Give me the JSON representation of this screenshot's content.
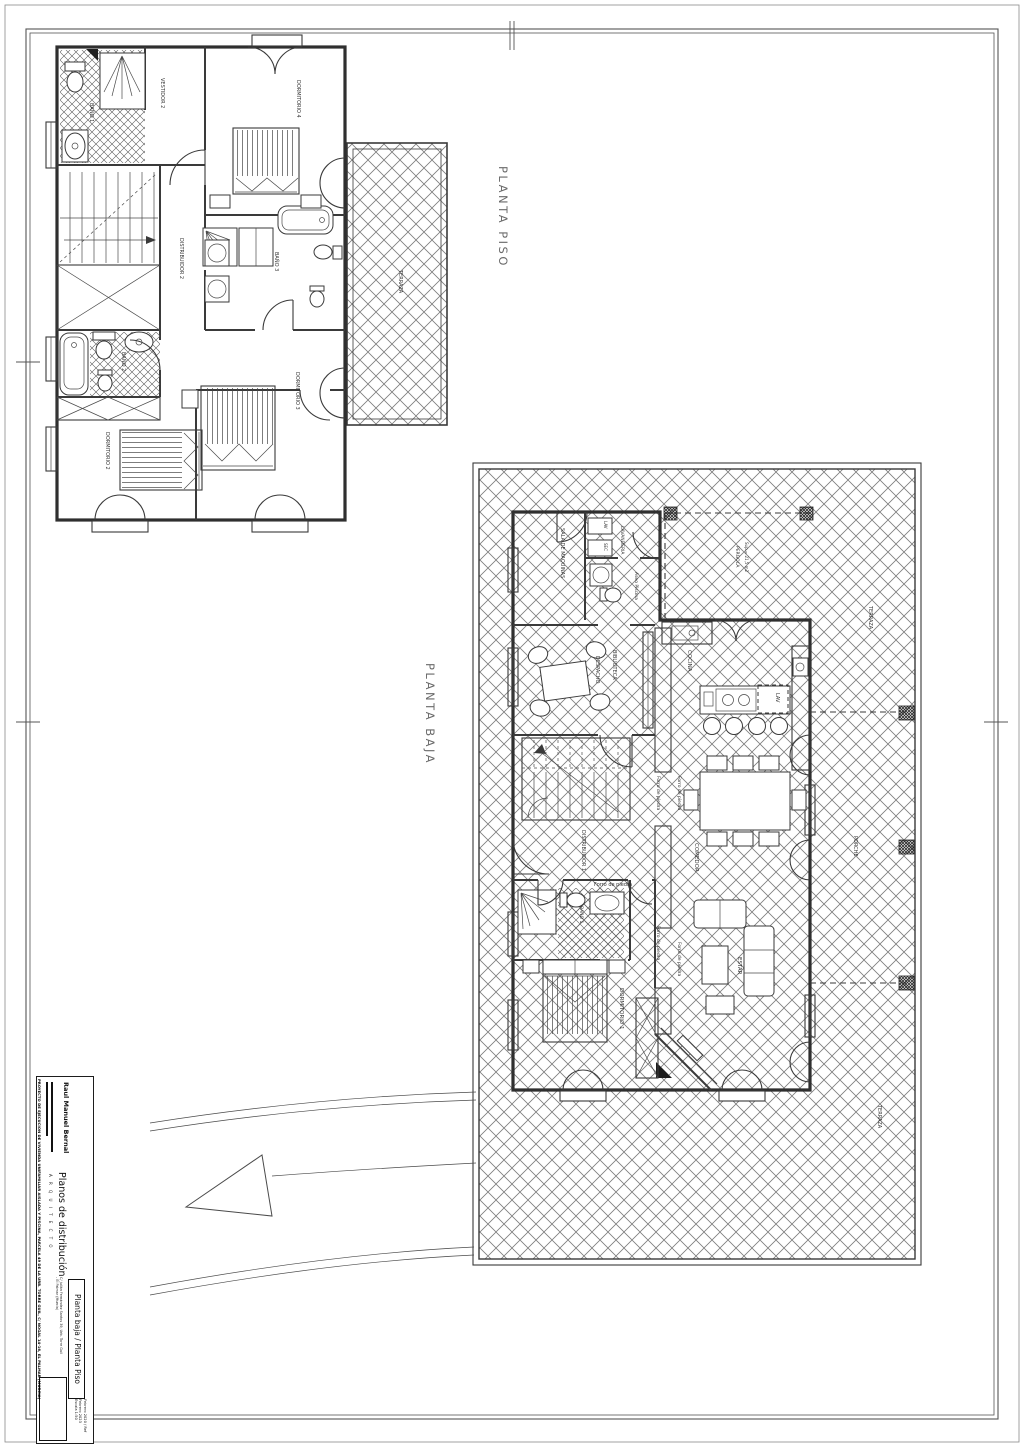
{
  "sheet_titles": {
    "planta_piso": "PLANTA PISO",
    "planta_baja": "PLANTA BAJA"
  },
  "planta_piso": {
    "rooms": {
      "bano1": "BAÑO 1",
      "vestidor2": "VESTIDOR 2",
      "dormitorio4": "DORMITORIO 4",
      "distribuidor2": "DISTRIBUIDOR 2",
      "bano3": "BAÑO 3",
      "bano2": "BAÑO 2",
      "dormitorio2": "DORMITORIO 2",
      "dormitorio3": "DORMITORIO 3",
      "terraza": "TERRAZA"
    }
  },
  "planta_baja": {
    "rooms": {
      "sala_maquinas": "SALA DE MAQUINAS",
      "lavanderia": "LAVANDERIA",
      "aseo_piscina": "Aseo Piscina",
      "despacho": "DESPACHO",
      "biblioteca": "BIBLIOTECA",
      "cocina": "COCINA",
      "distribuidor1": "DISTRIBUIDOR 1",
      "comedor": "COMEDOR",
      "estar": "ESTAR",
      "dormitorio1": "DORMITORIO 1",
      "bano1": "BAÑO 1",
      "porche": "PORCHE",
      "terraza": "TERRAZA"
    },
    "annotations": {
      "forro_de_piedra": "Forro de piedra",
      "pergola": "PERGOLA",
      "pergola_sup": "Sup.= 21,5 m2",
      "lav": "LAV",
      "sec": "SEC"
    }
  },
  "title_block": {
    "architect_name": "Raul Manuel Bernal",
    "studio_label": "A R Q U I T E C T O",
    "doc_title": "Planos de distribución",
    "sheet_name": "Planta baja / Planta Piso",
    "address": "C/ Julián Fernández Santos 39, Urb. Torre Guil - El Palmar (Murcia)",
    "date_ref": "Febrero 2020 / Ref Febrero 2023",
    "scale": "Escala 1:50",
    "project_line": "PROYECTO DE EJECUCION DE VIVIENDA UNIFAMILIAR AISLADA Y PISCINA, PARCELA 49 DE LA URB. TORRE GUIL, C/ NOGAL 14-16, EL PALMAR (MURCIA)"
  }
}
